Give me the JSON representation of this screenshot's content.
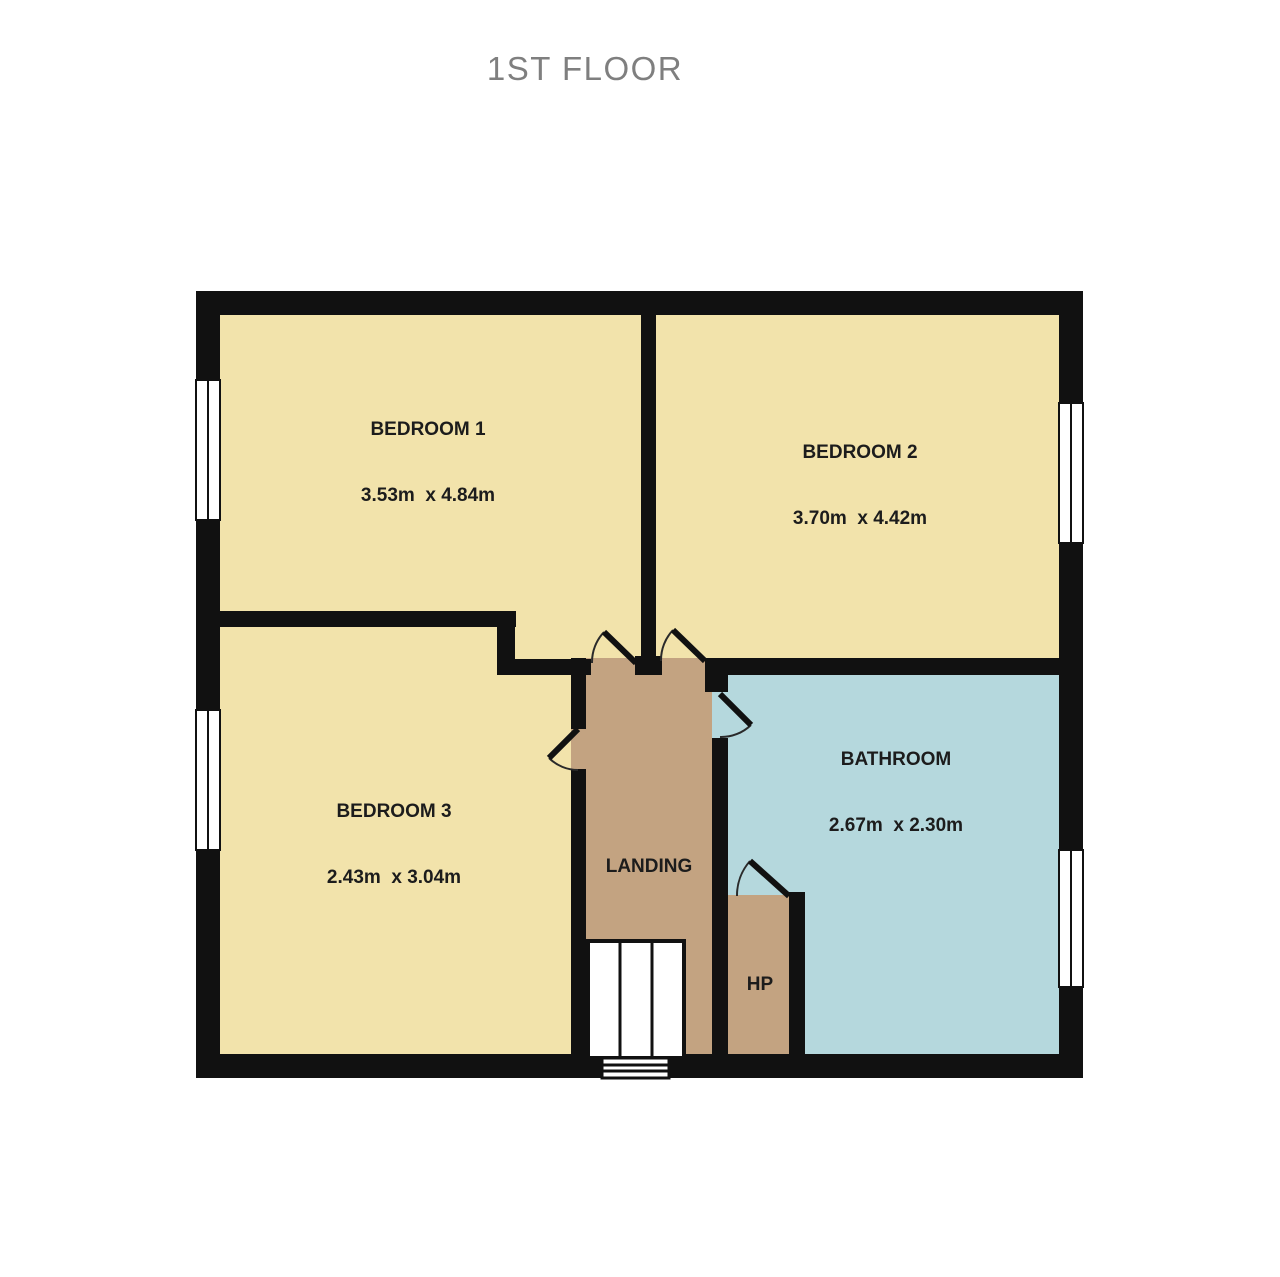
{
  "title": "1ST FLOOR",
  "colors": {
    "wall": "#111111",
    "room_cream": "#f2e3ab",
    "hall_tan": "#c3a381",
    "bathroom_blue": "#b5d8dd",
    "label_ink": "#1c1c1c",
    "title_gray": "#7f7f7f",
    "background": "#ffffff"
  },
  "rooms": [
    {
      "name": "BEDROOM 1",
      "dims": "3.53m  x 4.84m"
    },
    {
      "name": "BEDROOM 2",
      "dims": "3.70m  x 4.42m"
    },
    {
      "name": "BEDROOM 3",
      "dims": "2.43m  x 3.04m"
    },
    {
      "name": "BATHROOM",
      "dims": "2.67m  x 2.30m"
    },
    {
      "name": "LANDING",
      "dims": ""
    },
    {
      "name": "HP",
      "dims": ""
    }
  ]
}
